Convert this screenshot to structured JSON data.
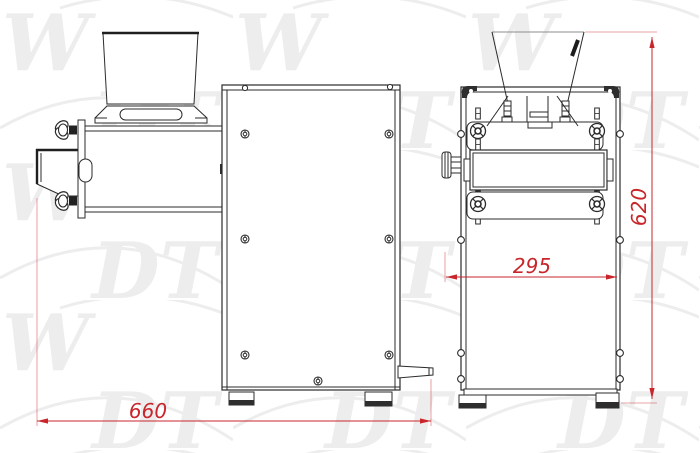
{
  "watermark": {
    "w": "W",
    "dt": "DT"
  },
  "dimensions": {
    "overall_width": "660",
    "front_width": "295",
    "overall_height": "620"
  },
  "colors": {
    "dimension_red": "#c8262b",
    "line_dark": "#2b2b2b",
    "watermark_gray": "#ededed",
    "background": "#ffffff"
  }
}
